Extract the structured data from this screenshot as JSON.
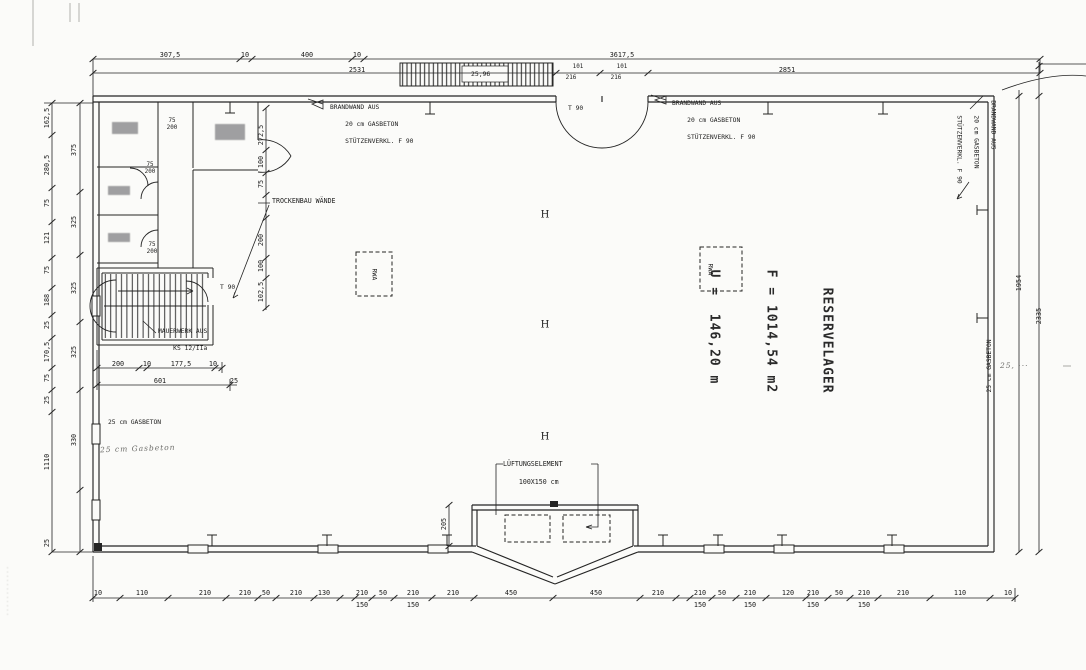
{
  "annotations": {
    "reservelager": {
      "name": "RESERVELAGER",
      "area": "F = 1014,54 m2",
      "perimeter": "U =  146,20 m"
    },
    "brandwand": [
      "BRANDWAND AUS",
      "20 cm GASBETON",
      "STÜTZENVERKL. F 90"
    ],
    "trockenbau": "TROCKENBAU WÄNDE",
    "mauerwerk": [
      "MAUERWERK AUS",
      "KS 12/IIa"
    ],
    "gasbeton_left": "25 cm GASBETON",
    "gasbeton_left_hand": "25 cm Gasbeton",
    "gasbeton_right": "25 cm GASBETON",
    "lueftung": [
      "LÜFTUNGSELEMENT",
      "100X150 cm"
    ],
    "rwa": "RWA",
    "t90_top": "T 90",
    "t90_stair": "T 90",
    "ramp_dim": "25,96",
    "hand_note_right": "25, ···",
    "watermark": "············",
    "h_columns": [
      {
        "x": 545,
        "y": 215,
        "v": "H"
      },
      {
        "x": 545,
        "y": 325,
        "v": "H"
      },
      {
        "x": 545,
        "y": 437,
        "v": "H"
      }
    ]
  },
  "dims": {
    "top_upper": [
      {
        "x": 170,
        "v": "307,5"
      },
      {
        "x": 245,
        "v": "10"
      },
      {
        "x": 307,
        "v": "400"
      },
      {
        "x": 357,
        "v": "10"
      },
      {
        "x": 622,
        "v": "3617,5"
      }
    ],
    "top_lower": [
      {
        "x": 357,
        "v": "2531"
      },
      {
        "x": 787,
        "v": "2851"
      }
    ],
    "door_w": [
      {
        "x": 578,
        "v": "101"
      },
      {
        "x": 622,
        "v": "101"
      }
    ],
    "door_h": [
      {
        "x": 571,
        "v": "216"
      },
      {
        "x": 616,
        "v": "216"
      }
    ],
    "right_chain": [
      {
        "x": 1019,
        "y": 283,
        "v": "1954"
      },
      {
        "x": 1039,
        "y": 316,
        "v": "2335"
      }
    ],
    "left_outer": [
      {
        "y": 118,
        "v": "162,5"
      },
      {
        "y": 165,
        "v": "280,5"
      },
      {
        "y": 203,
        "v": "75"
      },
      {
        "y": 238,
        "v": "121"
      },
      {
        "y": 270,
        "v": "75"
      },
      {
        "y": 300,
        "v": "188"
      },
      {
        "y": 325,
        "v": "25"
      },
      {
        "y": 352,
        "v": "170,5"
      },
      {
        "y": 378,
        "v": "75"
      },
      {
        "y": 400,
        "v": "25"
      },
      {
        "y": 462,
        "v": "1110"
      },
      {
        "y": 543,
        "v": "25"
      }
    ],
    "left_inner": [
      {
        "y": 150,
        "v": "375"
      },
      {
        "y": 222,
        "v": "325"
      },
      {
        "y": 288,
        "v": "325"
      },
      {
        "y": 352,
        "v": "325"
      },
      {
        "y": 440,
        "v": "330"
      }
    ],
    "interior_chain": [
      {
        "y": 135,
        "v": "272,5"
      },
      {
        "y": 162,
        "v": "100"
      },
      {
        "y": 184,
        "v": "75"
      },
      {
        "y": 240,
        "v": "200"
      },
      {
        "y": 266,
        "v": "100"
      },
      {
        "y": 292,
        "v": "102,5"
      }
    ],
    "stairs_row1": [
      {
        "x": 118,
        "v": "200"
      },
      {
        "x": 147,
        "v": "10"
      },
      {
        "x": 181,
        "v": "177,5"
      },
      {
        "x": 213,
        "v": "10"
      }
    ],
    "stairs_row2": [
      {
        "x": 160,
        "v": "601"
      },
      {
        "x": 234,
        "v": "25"
      }
    ],
    "bay": [
      {
        "x": 444,
        "y": 524,
        "v": "205"
      }
    ],
    "door_pairs": [
      {
        "x": 172,
        "y": 118,
        "w": "75",
        "h": "200"
      },
      {
        "x": 150,
        "y": 162,
        "w": "75",
        "h": "200"
      },
      {
        "x": 152,
        "y": 242,
        "w": "75",
        "h": "200"
      }
    ],
    "bottom": [
      {
        "x": 98,
        "v": "10"
      },
      {
        "x": 142,
        "v": "110"
      },
      {
        "x": 205,
        "v": "210"
      },
      {
        "x": 245,
        "v": "210"
      },
      {
        "x": 266,
        "v": "50"
      },
      {
        "x": 296,
        "v": "210"
      },
      {
        "x": 324,
        "v": "130"
      },
      {
        "x": 362,
        "v": "210",
        "sub": "150"
      },
      {
        "x": 383,
        "v": "50"
      },
      {
        "x": 413,
        "v": "210",
        "sub": "150"
      },
      {
        "x": 453,
        "v": "210"
      },
      {
        "x": 511,
        "v": "450"
      },
      {
        "x": 596,
        "v": "450"
      },
      {
        "x": 658,
        "v": "210"
      },
      {
        "x": 700,
        "v": "210",
        "sub": "150"
      },
      {
        "x": 722,
        "v": "50"
      },
      {
        "x": 750,
        "v": "210",
        "sub": "150"
      },
      {
        "x": 788,
        "v": "120"
      },
      {
        "x": 813,
        "v": "210",
        "sub": "150"
      },
      {
        "x": 839,
        "v": "50"
      },
      {
        "x": 864,
        "v": "210",
        "sub": "150"
      },
      {
        "x": 903,
        "v": "210"
      },
      {
        "x": 960,
        "v": "110"
      },
      {
        "x": 1008,
        "v": "10"
      }
    ]
  }
}
